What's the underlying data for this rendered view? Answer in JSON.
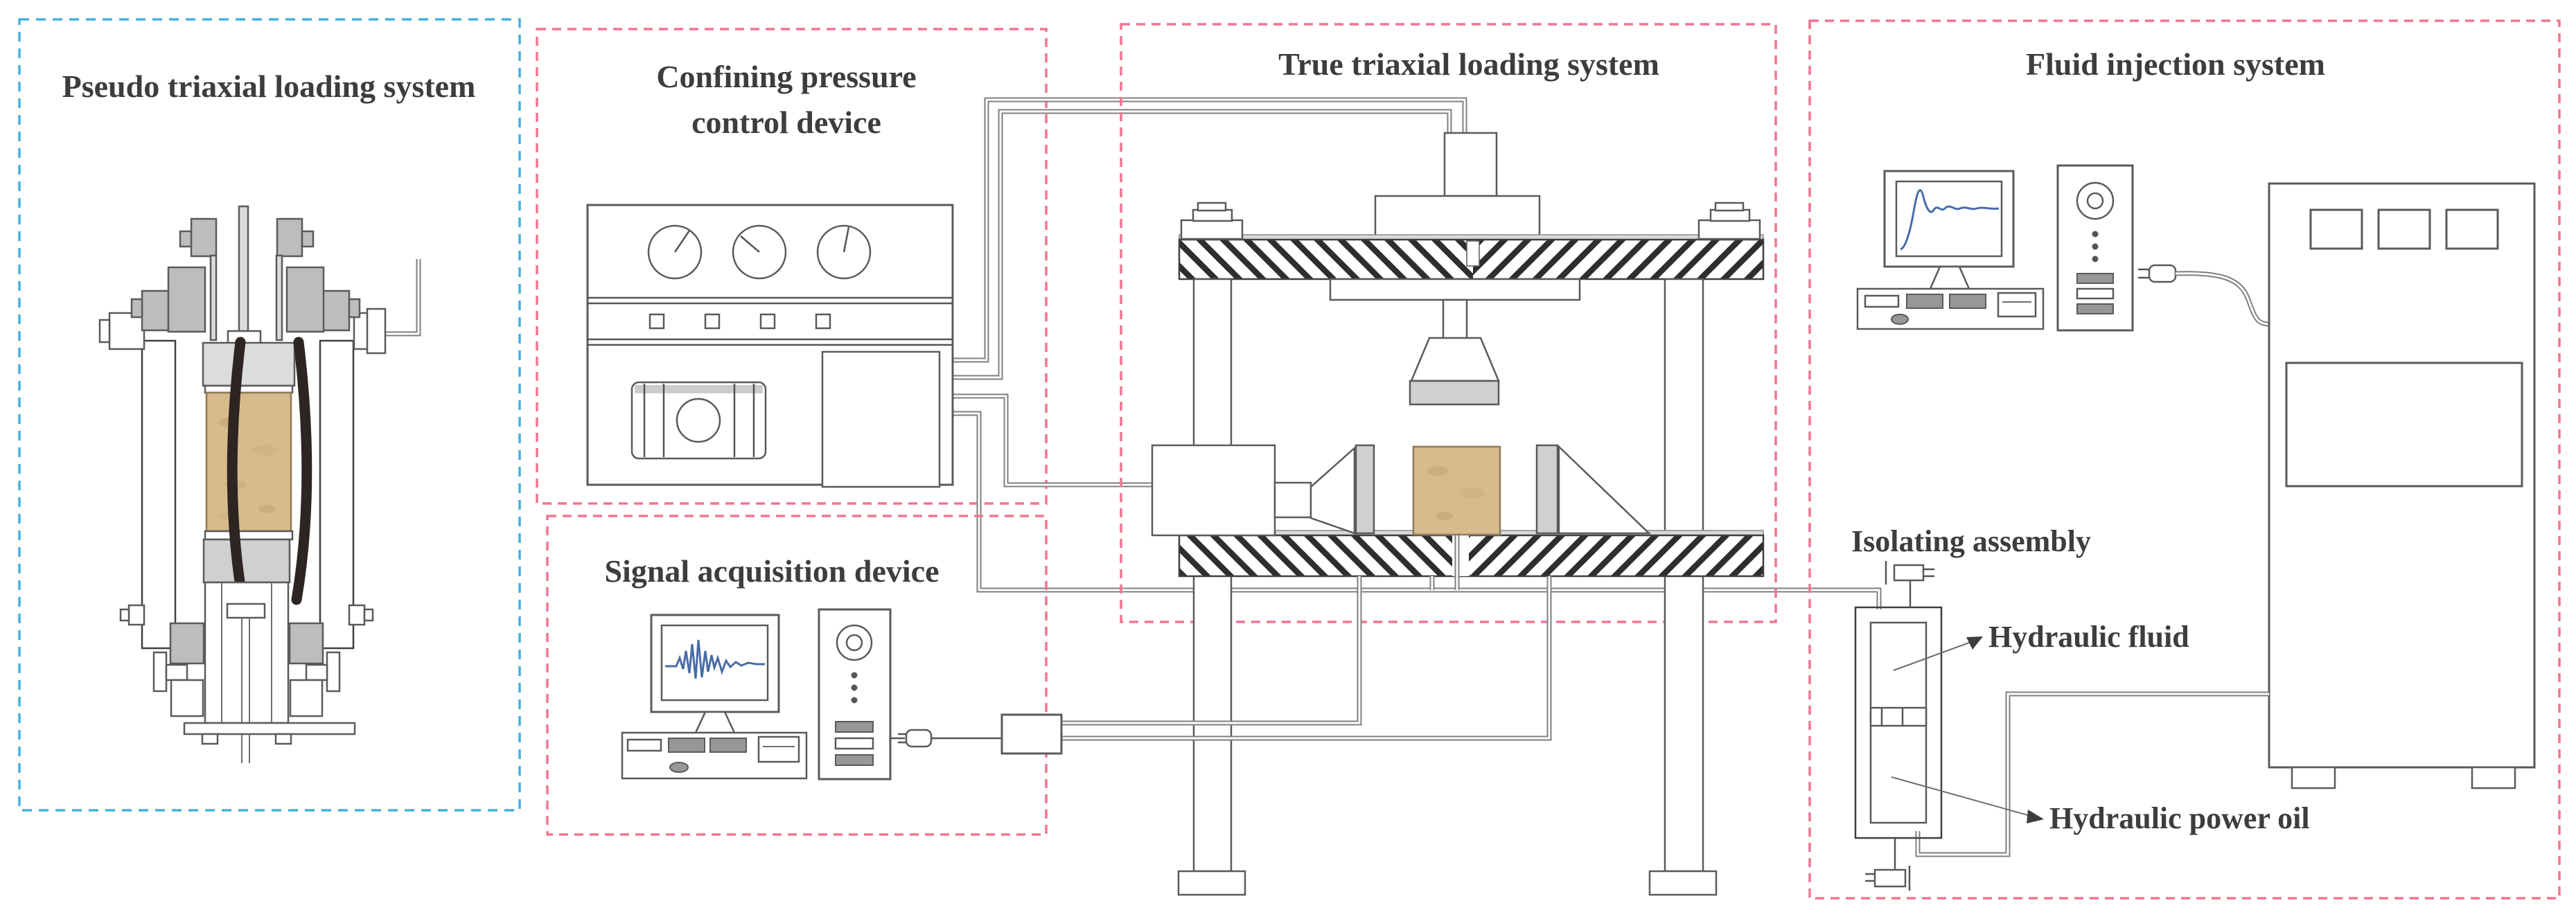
{
  "panels": {
    "pseudo": {
      "title": "Pseudo triaxial loading system",
      "border_color": "#44b1de"
    },
    "confining": {
      "title_line1": "Confining pressure",
      "title_line2": "control device",
      "border_color": "#f2758f"
    },
    "signal": {
      "title": "Signal acquisition device",
      "border_color": "#f2758f"
    },
    "true_triaxial": {
      "title": "True triaxial loading system",
      "border_color": "#f2758f"
    },
    "fluid": {
      "title": "Fluid injection system",
      "border_color": "#f2758f"
    }
  },
  "labels": {
    "isolating_assembly": "Isolating assembly",
    "hydraulic_fluid": "Hydraulic fluid",
    "hydraulic_power_oil": "Hydraulic power oil"
  },
  "colors": {
    "blue_dashed_border": "#44b1de",
    "pink_dashed_border": "#f2758f",
    "specimen_tan": "#d8bb8d",
    "waveform_blue": "#4a6da7",
    "line_gray": "#5a5a5a"
  },
  "icons": {
    "fan": "cooling-fan",
    "waveform": "signal-waveform",
    "plug": "power-plug",
    "valve": "shutoff-valve",
    "dial": "pressure-dial"
  }
}
